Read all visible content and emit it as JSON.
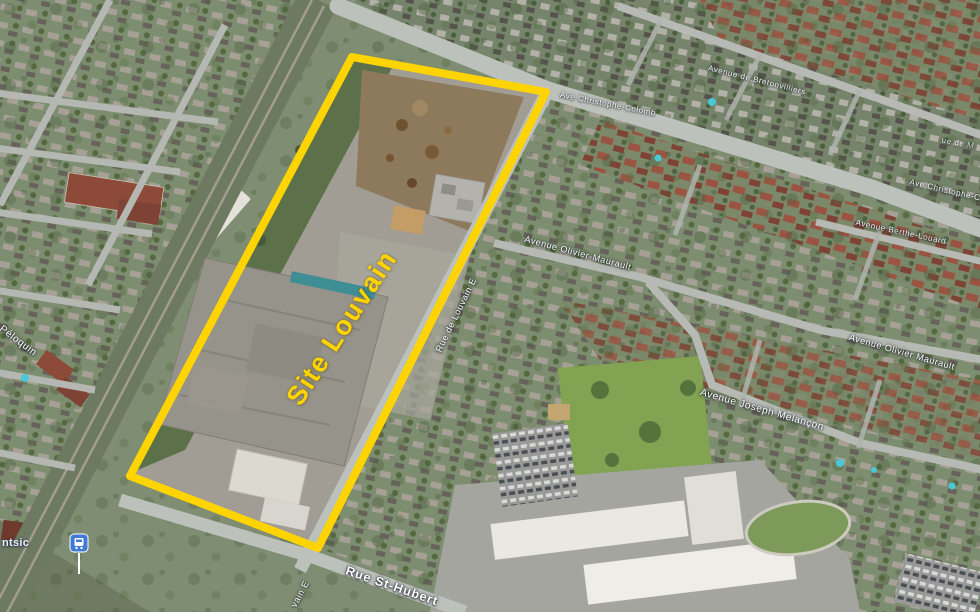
{
  "map": {
    "site": {
      "label": "Site Louvain",
      "outline_color": "#FFD400",
      "label_color": "#FFD400"
    },
    "street_labels": {
      "bretonvilliers": "Avenue de Bretonvilliers",
      "christophe_colomb": "Ave Christophe-Colomb",
      "christophe_colomb_partial": "Ave Christophe-C",
      "rue_de_m_partial": "ue de M",
      "olivier_maurault_upper": "Avenue Olivier-Maurault",
      "olivier_maurault_lower": "Avenue Olivier Maurault",
      "berthe_louard": "Avenue Berthe-Louard",
      "joseph_melancon": "Avenue Joseph Melançon",
      "louvain": "Rue de Louvain E",
      "louvain_partial": "vain E",
      "st_hubert": "Rue St-Hubert",
      "peloquin": "Péloquin"
    },
    "transit": {
      "station_label_partial": "ntsic",
      "icon_color": "#3F7AD9"
    }
  }
}
